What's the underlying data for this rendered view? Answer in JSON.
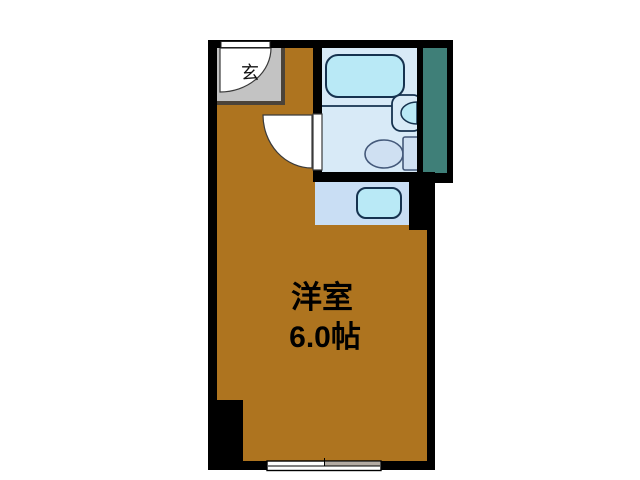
{
  "title": "間取り図",
  "colors": {
    "wall": "#000000",
    "room": "#ae741f",
    "entrance_floor": "#c3c3c3",
    "entrance_border": "#4b4339",
    "bath_floor": "#d8eaf7",
    "tub_fill": "#b9e9f6",
    "fixture_fill": "#cfe0f2",
    "fixture_stroke": "#44597a",
    "dark_stroke": "#16324f",
    "kitchen_floor": "#c9def4",
    "duct": "#3f7f78",
    "window_shade": "#b3aba3"
  },
  "rooms": {
    "main": {
      "name": "洋室",
      "size": "6.0帖"
    },
    "entrance": {
      "label": "玄"
    }
  },
  "fixtures": [
    "entry-door-swing",
    "room-door-swing",
    "bathtub",
    "wash-basin",
    "toilet",
    "kitchen-sink",
    "duct-space",
    "sliding-window"
  ]
}
